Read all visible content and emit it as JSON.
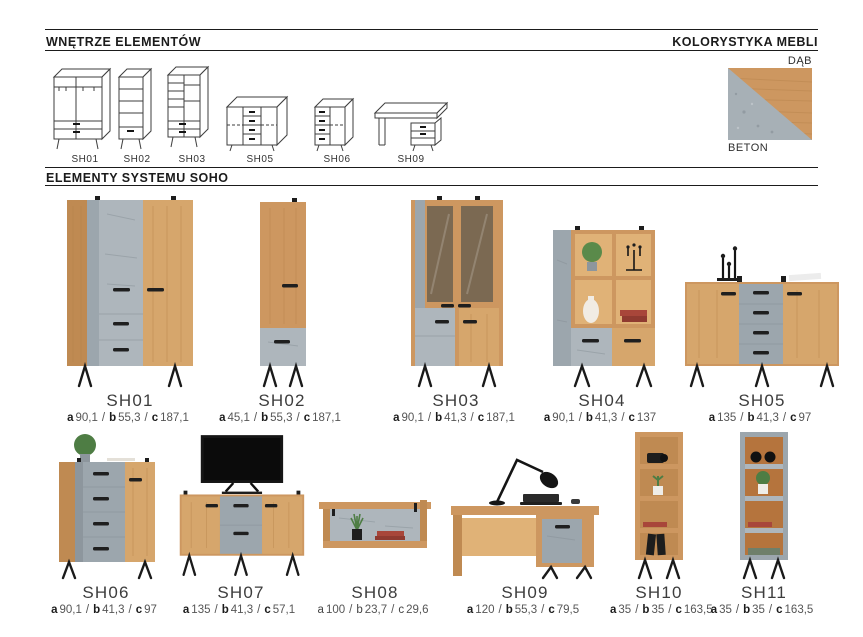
{
  "sections": {
    "interiors": {
      "title": "WNĘTRZE ELEMENTÓW"
    },
    "colors": {
      "title": "KOLORYSTYKA MEBLI",
      "oak_label": "DĄB",
      "concrete_label": "BETON"
    },
    "elements": {
      "title": "ELEMENTY SYSTEMU SOHO"
    }
  },
  "palette": {
    "oak": "#cd9760",
    "concrete": "#9ca6ad",
    "handle_black": "#1f1f1f",
    "text_dark": "#1b1b1b"
  },
  "interior_items": [
    {
      "code": "SH01"
    },
    {
      "code": "SH02"
    },
    {
      "code": "SH03"
    },
    {
      "code": "SH05"
    },
    {
      "code": "SH06"
    },
    {
      "code": "SH09"
    }
  ],
  "dim_letters": {
    "a": "a",
    "b": "b",
    "c": "c"
  },
  "dim_separator": "/",
  "products": [
    {
      "code": "SH01",
      "a": "90,1",
      "b": "55,3",
      "c": "187,1"
    },
    {
      "code": "SH02",
      "a": "45,1",
      "b": "55,3",
      "c": "187,1"
    },
    {
      "code": "SH03",
      "a": "90,1",
      "b": "41,3",
      "c": "187,1"
    },
    {
      "code": "SH04",
      "a": "90,1",
      "b": "41,3",
      "c": "137"
    },
    {
      "code": "SH05",
      "a": "135",
      "b": "41,3",
      "c": "97"
    },
    {
      "code": "SH06",
      "a": "90,1",
      "b": "41,3",
      "c": "97"
    },
    {
      "code": "SH07",
      "a": "135",
      "b": "41,3",
      "c": "57,1"
    },
    {
      "code": "SH08",
      "a": "100",
      "b": "23,7",
      "c": "29,6",
      "light_letters": true
    },
    {
      "code": "SH09",
      "a": "120",
      "b": "55,3",
      "c": "79,5"
    },
    {
      "code": "SH10",
      "a": "35",
      "b": "35",
      "c": "163,5"
    },
    {
      "code": "SH11",
      "a": "35",
      "b": "35",
      "c": "163,5"
    }
  ]
}
